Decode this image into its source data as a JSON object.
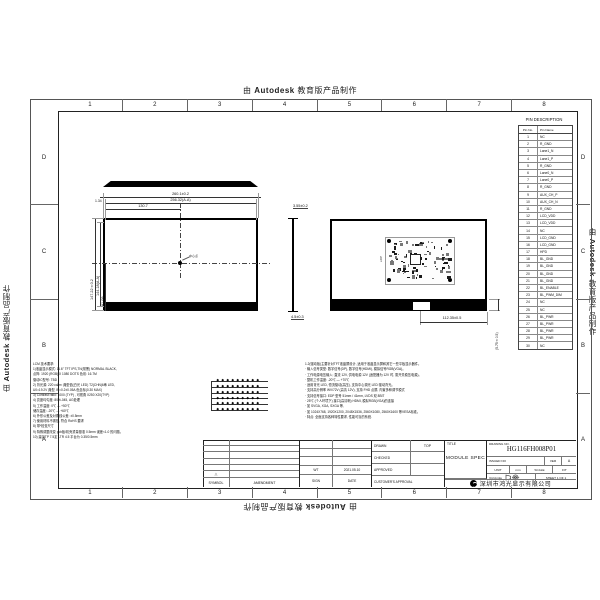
{
  "watermark": {
    "prefix": "由 ",
    "brand": "Autodesk",
    "suffix": " 教育版产品制作"
  },
  "border": {
    "columns": [
      "1",
      "2",
      "3",
      "4",
      "5",
      "6",
      "7",
      "8"
    ],
    "rows": [
      "D",
      "C",
      "B",
      "A"
    ]
  },
  "pin_table": {
    "title": "PIN DESCRIPTION",
    "headers": [
      "Pin No.",
      "Pin Name"
    ],
    "pins": [
      [
        "1",
        "NC"
      ],
      [
        "2",
        "R_GND"
      ],
      [
        "3",
        "Lane1_N"
      ],
      [
        "4",
        "Lane1_P"
      ],
      [
        "5",
        "R_GND"
      ],
      [
        "6",
        "Lane0_N"
      ],
      [
        "7",
        "Lane0_P"
      ],
      [
        "8",
        "R_GND"
      ],
      [
        "9",
        "AUX_CH_P"
      ],
      [
        "10",
        "AUX_CH_N"
      ],
      [
        "11",
        "R_GND"
      ],
      [
        "12",
        "LCD_VDD"
      ],
      [
        "13",
        "LCD_VDD"
      ],
      [
        "14",
        "NC"
      ],
      [
        "15",
        "LCD_GND"
      ],
      [
        "16",
        "LCD_GND"
      ],
      [
        "17",
        "HPD"
      ],
      [
        "18",
        "BL_GND"
      ],
      [
        "19",
        "BL_GND"
      ],
      [
        "20",
        "BL_GND"
      ],
      [
        "21",
        "BL_GND"
      ],
      [
        "22",
        "BL_ENABLE"
      ],
      [
        "23",
        "BL_PWM_DIM"
      ],
      [
        "24",
        "NC"
      ],
      [
        "25",
        "NC"
      ],
      [
        "26",
        "BL_PWR"
      ],
      [
        "27",
        "BL_PWR"
      ],
      [
        "28",
        "BL_PWR"
      ],
      [
        "29",
        "BL_PWR"
      ],
      [
        "30",
        "NC"
      ]
    ]
  },
  "front_view": {
    "width_dim": "260.1±0.2",
    "active_width_dim": "256.32(A.A)",
    "edge_dim": "1.34",
    "center_x_dim": "130.7",
    "height_dim": "147.22±0.2",
    "active_height_dim": "144.18(A.A)",
    "center_y_dim": "81.09",
    "center_note": "中心点"
  },
  "side_view": {
    "thickness_dim": "3.55±0.2",
    "bottom_dim": "4.5±0.3"
  },
  "rear_view": {
    "connector_dim": "112.35±0.5",
    "band_dim": "(5.75±0.5)",
    "pcb_label": "eDP"
  },
  "led_diagram": {
    "rows": 6,
    "leds_per_row": 9
  },
  "notes_left": {
    "lines": [
      "LCM 技术要求:",
      "1)液晶显示模式: 11.6\" TFT  IPS,TN(常黑) NORMAL BLACK,",
      "  点阵: 1920 (RGB) X 1080 DOTS  色彩: 16.7M",
      "  驱动IC型号: TBD",
      "2) 背光源: 220 cd/m² 典型值(白光 LED) T2(CHN)6串 LED,",
      "  U0=19.2V 典型, IF=0.2±0.05A  色坐标(0.30 MAX)",
      "3) Contrast ratio: 1000 (TYP) , 可视角 X250 X20(TYP)",
      "4) 亮度均匀度: 80%-045, AG处理",
      "5) 工作温度: 0℃ — +50℃",
      "  储存温度: -20℃ — +60℃",
      "6) 外形公差及对角线公差: ±0.5mm",
      "7) 使用材料不锈蚀, 符合 RoHS 要求",
      "8) 带*检查尺寸",
      "9) 特殊调整改变 pcb板/机壳重量基准 0.5mm 误差<1.0 的问题。",
      "10) 建议TP 7.5定 LTR 4.5 平台为 0.35/0.5mm"
    ]
  },
  "notes_right": {
    "lines": [
      "1.2(驱动板)主要针对TFT液晶屏设计, 适用于液晶显示屏和其它一些平板显示器件。",
      "· 输入信号类型: 数字信号(DP), 数字信号(HDMI), 模拟信号RGB(VGA)。",
      "· 工作电源电压输入: 直流 12V, 供电电源 12V (适配器为 12V 时, 需开关稳压电源)。",
      "· 整机工作温度: -20℃ — +70℃",
      "· 适用背光 LED, 恒流驱动(高压), 支持中心调光 LED 驱动背光。",
      "· 支持高分辨率 WV/72V (高清 12V), 支持 FHD 点屏, 内置多种调节模式",
      "· 支持信号接口: EDP 型号 51mm / 41mm, LVDS 双 8BIT",
      "· 25℃ (个人环境下) 接口(高清晰) HDMI, 模拟RGB(VGA)的连接",
      "· 如 SVGA, XGA, SXGA 等,",
      "· 如 1024X768, 1920X1200, 2048X1536, 2560X1080, 2560X1600 等VESA标准。",
      "· 特点: 全面支持各种特性要求, 性能可靠的系统."
    ]
  },
  "title_block": {
    "amendment": {
      "symbol_header": "SYMBOL",
      "amendment_header": "AMENDMENT",
      "revision_triangle": "△"
    },
    "revision": {
      "sign_value": "WT",
      "date_value": "2021.05.10",
      "sign_label": "SIGN",
      "date_label": "DATE"
    },
    "drawn_label": "DRAWN",
    "drawn_value": "TOP",
    "checked_label": "CHECKED",
    "approved_label": "APPROVED",
    "customer_label": "CUSTOMER'S APPROVAL",
    "title_label": "TITLE",
    "title_value": "MODULE SPEC",
    "drawing_no_label": "DRAWING NO.",
    "drawing_no_value": "HG116FH008P01",
    "issued_label": "ISSUED NO",
    "ver_label": "VER",
    "ver_value": "A",
    "unit_label": "UNIT",
    "unit_value": "mm",
    "scale_label": "SCALE",
    "scale_value": "FIT",
    "angle_label": "3rd Angle",
    "sheet_label": "SHEET 1 OF 1",
    "company_name": "深圳市鸿光显示有限公司"
  }
}
